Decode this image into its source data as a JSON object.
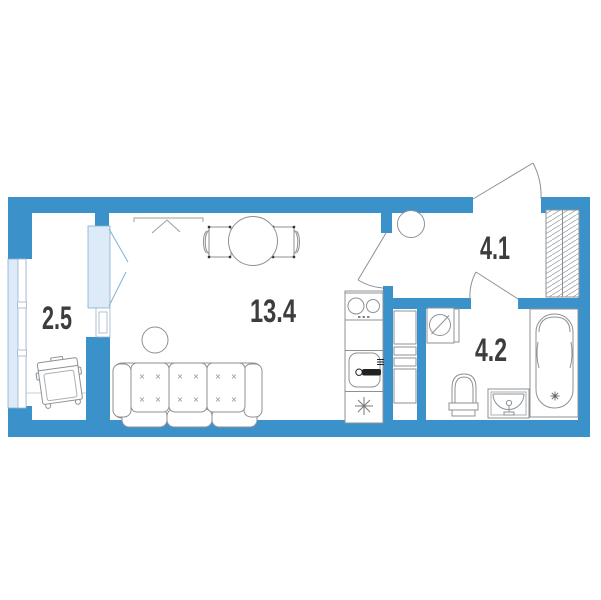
{
  "plan": {
    "type": "apartment-floor-plan",
    "rooms": {
      "balcony": {
        "area": "2.5",
        "fixtures": [
          "armchair",
          "window"
        ]
      },
      "living": {
        "area": "13.4",
        "fixtures": [
          "wardrobe",
          "dining-table",
          "chair",
          "chair",
          "pouf",
          "sofa",
          "stove",
          "kitchen-sink"
        ]
      },
      "hallway": {
        "area": "4.1",
        "fixtures": [
          "stool",
          "closet"
        ]
      },
      "bathroom": {
        "area": "4.2",
        "fixtures": [
          "washing-machine",
          "toilet",
          "sink",
          "bathtub"
        ]
      }
    },
    "colors": {
      "wall": "#3b92cb",
      "glazing_fill": "#dcebf7",
      "glazing_border": "#85aecf",
      "line": "#8c9196",
      "label": "#3d3d3d"
    }
  }
}
